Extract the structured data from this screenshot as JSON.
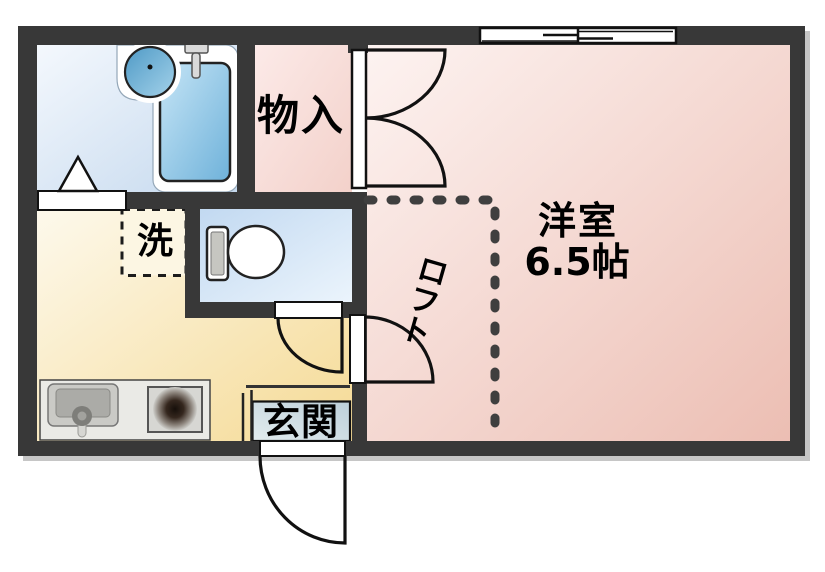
{
  "plan": {
    "rooms": {
      "storage": {
        "label": "物入"
      },
      "western_room": {
        "label": "洋室",
        "size": "6.5帖"
      },
      "laundry": {
        "label": "洗"
      },
      "loft": {
        "label": "ロフト",
        "chars": [
          "ロ",
          "フ",
          "ト"
        ]
      },
      "entrance": {
        "label": "玄関"
      }
    },
    "fixtures": {
      "bathtub": "bathtub-icon",
      "wash_basin": "basin-icon",
      "faucet": "faucet-icon",
      "toilet": "toilet-icon",
      "kitchen_sink": "kitchen-sink-icon",
      "stove": "stove-burner-icon",
      "window": "sliding-window-icon",
      "folding_door": "folding-door-icon"
    },
    "colors": {
      "wall": "#383838",
      "bathroom": "#cfe0f0",
      "storage_room": "#f7dcd6",
      "main_room": "#f3cfc6",
      "kitchen": "#f9e8b8",
      "toilet_room": "#d6e6f6",
      "entrance_floor": "#cfe0e6",
      "loft_dash": "#3f3f3f"
    }
  }
}
